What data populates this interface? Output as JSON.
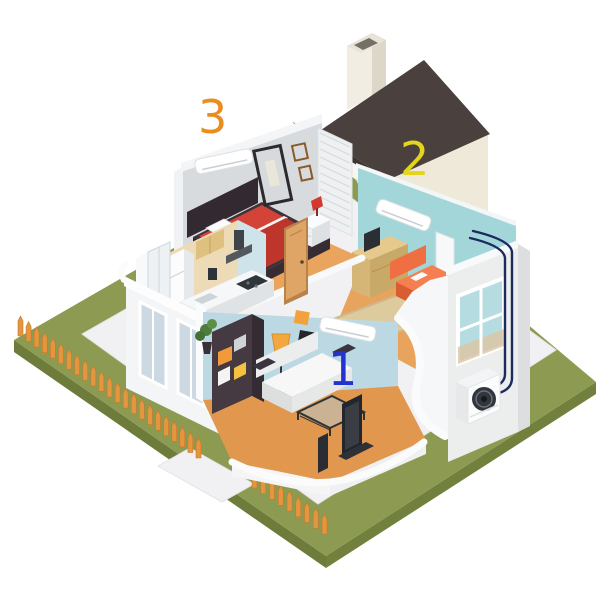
{
  "scene": {
    "description": "Isometric cutaway illustration of a single-storey house showing a three-zone ductless air-conditioning system with an outdoor condenser unit",
    "background_color": "#ffffff"
  },
  "zone_labels": [
    {
      "id": "zone-1",
      "text": "1",
      "color": "#2433cf",
      "room": "living-room"
    },
    {
      "id": "zone-2",
      "text": "2",
      "color": "#e3d41d",
      "room": "family-room"
    },
    {
      "id": "zone-3",
      "text": "3",
      "color": "#ea8c1e",
      "room": "bedroom"
    }
  ],
  "palette": {
    "lawn": "#8d9b52",
    "lawn_side": "#6d7b3b",
    "path": "#f1f1f3",
    "fence": "#e5953d",
    "roof": "#4a413e",
    "gable": "#efe9da",
    "chimney": "#f2ede2",
    "exterior_wall": "#f4f5f6",
    "bedroom_wall": "#d8dbde",
    "kitchen_wall": "#eddbb8",
    "zone1_wall": "#bcd8e3",
    "zone2_wall": "#a2d6d9",
    "wood_floor": "#e8a45c",
    "rug": "#ddcb9e",
    "bed_red": "#d44338",
    "sofa_orange": "#f57f50",
    "sofa_white": "#f6f7f6",
    "shelving_dark": "#463a42",
    "lamp_yellow": "#f2a83e",
    "pipe_navy": "#1c2a5c",
    "condenser_fan": "#31363c"
  },
  "rooms": [
    {
      "zone": "3",
      "name": "bedroom",
      "items": [
        "wall AC unit",
        "double bed",
        "nightstand with red lamp",
        "wall mirror",
        "picture frames",
        "louvered closet",
        "wooden door"
      ]
    },
    {
      "zone": "2",
      "name": "family-room",
      "items": [
        "wall AC unit",
        "orange sofa",
        "wooden sideboard with TV",
        "area rug",
        "potted plant",
        "doorway",
        "white cabinet"
      ]
    },
    {
      "zone": "1",
      "name": "living-room",
      "items": [
        "wall AC unit",
        "white sofa",
        "glass coffee table",
        "TV",
        "shelving unit",
        "floor lamp",
        "potted plant",
        "picture frames"
      ]
    },
    {
      "zone": "",
      "name": "kitchen",
      "items": [
        "refrigerator",
        "wall cabinets",
        "range hood",
        "counter with cooktop"
      ]
    },
    {
      "zone": "",
      "name": "bathroom",
      "items": [
        "shower"
      ]
    }
  ],
  "exterior": {
    "items": [
      "dark gable roof",
      "chimney",
      "outdoor condenser unit",
      "refrigerant pipes",
      "orange picket fence",
      "green lawn",
      "white walkway",
      "window"
    ]
  }
}
